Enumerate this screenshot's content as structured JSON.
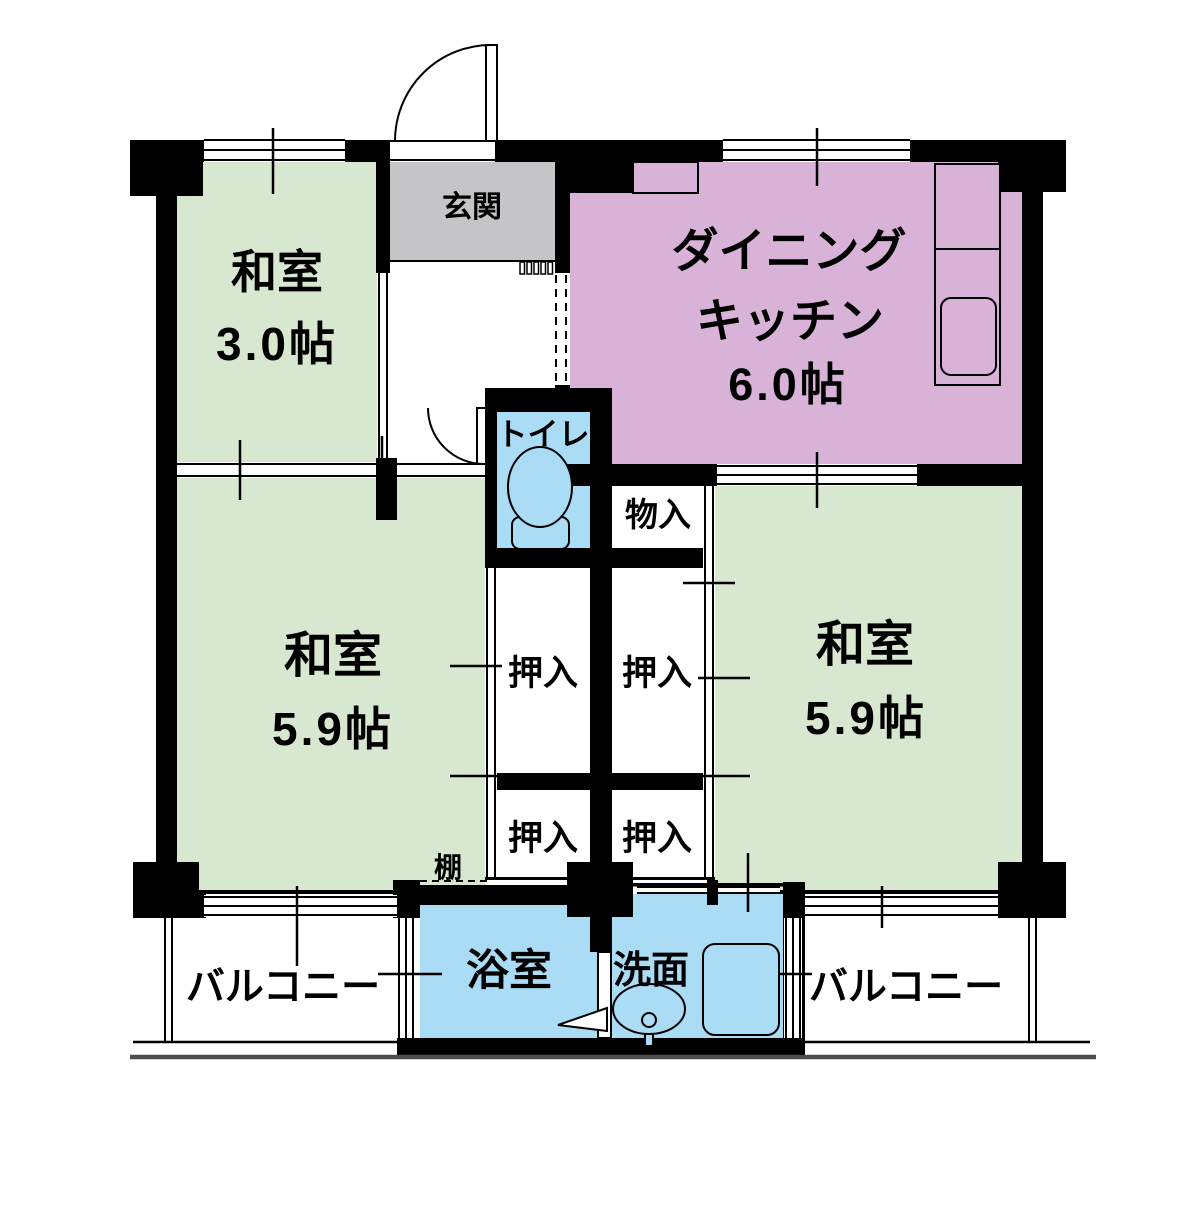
{
  "title": "2DK apartment floor plan",
  "colors": {
    "tatami_green": "#d8e8d0",
    "kitchen_pink": "#d9b3d7",
    "wet_area_blue": "#aadcf5",
    "entry_gray": "#c5c5c7",
    "wall_black": "#000000",
    "ground_gray": "#4d4d4d"
  },
  "rooms": {
    "washitsu_small": {
      "name": "和室",
      "size": "3.0帖"
    },
    "genkan": {
      "name": "玄関"
    },
    "dining_kitchen": {
      "line1": "ダイニング",
      "line2": "キッチン",
      "size": "6.0帖"
    },
    "toilet": {
      "name": "トイレ"
    },
    "mononyu": {
      "name": "物入"
    },
    "washitsu_left": {
      "name": "和室",
      "size": "5.9帖"
    },
    "washitsu_right": {
      "name": "和室",
      "size": "5.9帖"
    },
    "oshiire_upper_left": {
      "name": "押入"
    },
    "oshiire_upper_right": {
      "name": "押入"
    },
    "oshiire_lower_left": {
      "name": "押入"
    },
    "oshiire_lower_right": {
      "name": "押入"
    },
    "tana": {
      "name": "棚"
    },
    "bath": {
      "name": "浴室"
    },
    "senmen": {
      "name": "洗面"
    },
    "balcony_left": {
      "name": "バルコニー"
    },
    "balcony_right": {
      "name": "バルコニー"
    }
  },
  "icons": {
    "toilet_icon": "toilet bowl with tank",
    "sink_icon": "washbasin oval",
    "kitchen_counter_icon": "counter with sink",
    "door_arc_icon": "door swing arc",
    "bath_door_arrow_icon": "left-pointing arrow"
  }
}
